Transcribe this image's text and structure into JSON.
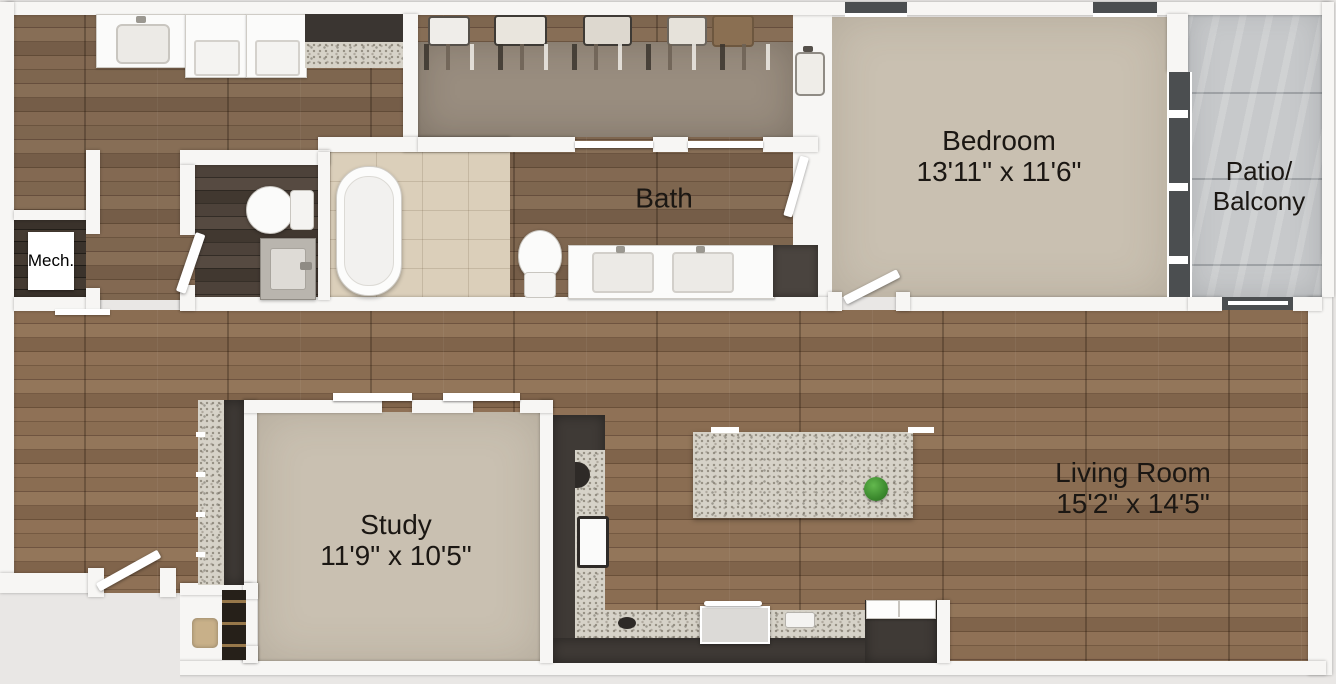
{
  "rooms": {
    "bedroom": {
      "name": "Bedroom",
      "dims": "13'11\" x 11'6\""
    },
    "patio": {
      "name_line1": "Patio/",
      "name_line2": "Balcony"
    },
    "bath": {
      "name": "Bath"
    },
    "mech": {
      "name": "Mech."
    },
    "study": {
      "name": "Study",
      "dims": "11'9\" x 10'5\""
    },
    "living_room": {
      "name": "Living Room",
      "dims": "15'2\" x 14'5\""
    }
  },
  "fixtures": {
    "laundry": [
      "sink-counter",
      "washer",
      "dryer",
      "dark-cabinet-counter"
    ],
    "walk_in_closet": [
      "suitcases-on-shelf",
      "hanging-clothes",
      "storage-basket",
      "standing-suitcase"
    ],
    "bath": [
      "freestanding-tub",
      "toilet",
      "double-sink-vanity",
      "linen-cabinet",
      "tile-floor"
    ],
    "powder_room": [
      "toilet",
      "sink-vanity",
      "swing-door"
    ],
    "mech_room": [
      "mech-unit"
    ],
    "kitchen": [
      "l-shaped-granite-counter",
      "undermount-sink",
      "range",
      "refrigerator",
      "kitchen-island",
      "green-plant"
    ],
    "entry": [
      "entry-swing-door",
      "coat-closet-shelving",
      "basket"
    ],
    "bedroom": [
      "swing-door",
      "window-wall",
      "top-windows"
    ],
    "patio": [
      "sliding-glass-door",
      "concrete-floor"
    ]
  },
  "colors": {
    "background": "#e9e7e5",
    "wall": "#f7f6f4",
    "wood_floor": "#85684f",
    "carpet": "#c9c0b1",
    "closet_carpet": "#998d7f",
    "bath_tile": "#dbcfba",
    "patio_concrete": "#c7c9cb",
    "granite_counter": "#d6d2c8",
    "dark_cabinet": "#3f3a36",
    "dark_wood": "#463c35",
    "label_text": "#1b1713",
    "plant_green": "#4a9b3a"
  }
}
